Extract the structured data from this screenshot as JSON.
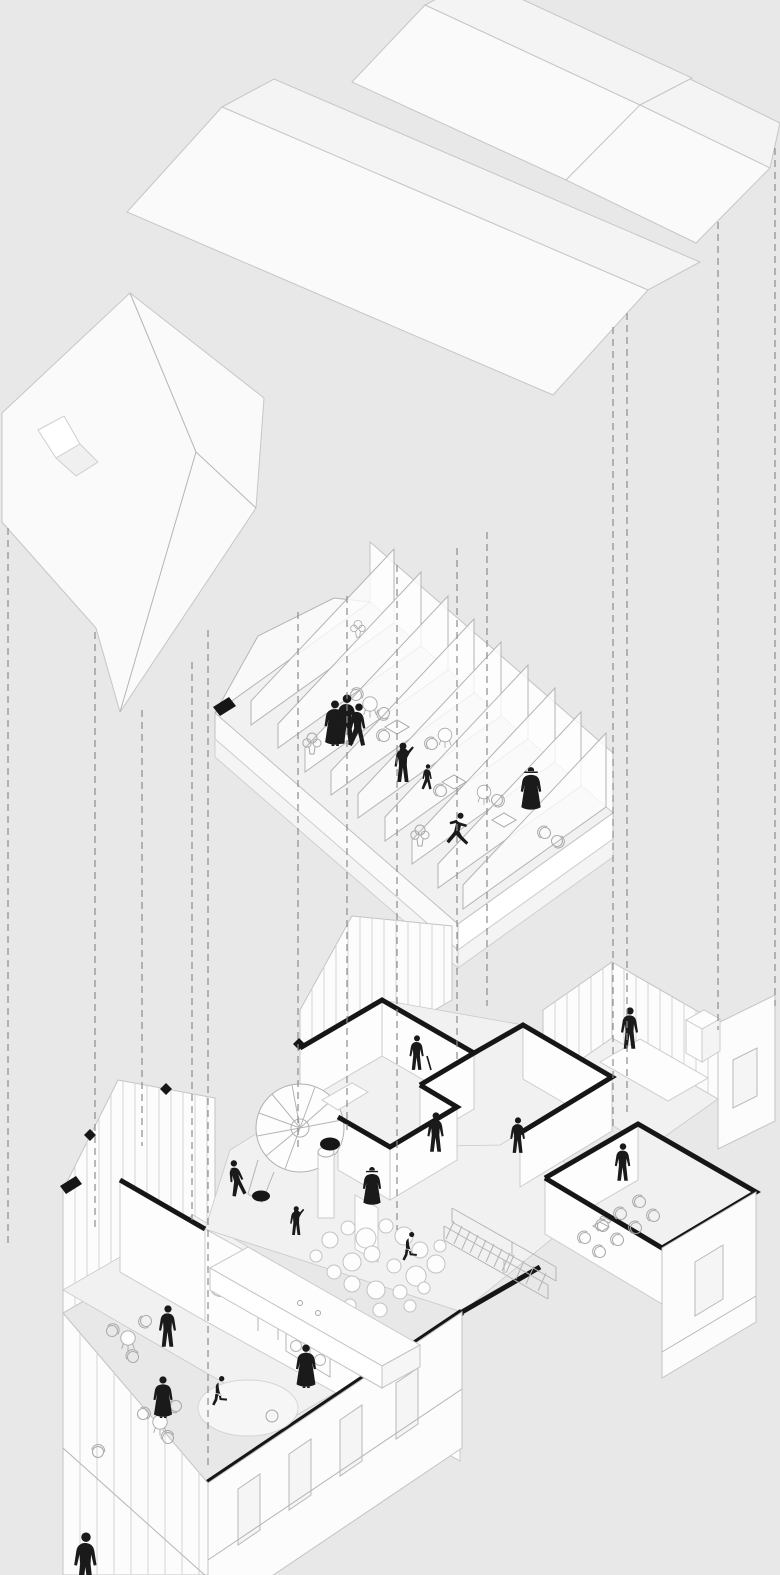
{
  "meta": {
    "title": "Exploded axonometric diagram of a two-storey gabled building",
    "type": "architectural-exploded-axonometric",
    "projection_style": "isometric",
    "visible_text": "none"
  },
  "palette": {
    "background": "#e8e8e8",
    "roof_white": "#fafafa",
    "roof_shaded": "#f4f4f4",
    "wall_white": "#fcfcfc",
    "floor_grey": "#f1f1f1",
    "line_light": "#c6c6c6",
    "line_mid": "#b0b0b0",
    "ink_black": "#161616",
    "dash_grey": "#8d8d8d"
  },
  "levels": [
    {
      "id": "roofs",
      "label": "detached roof planes",
      "elements": [
        "central gabled roof plane",
        "twin gable roof planes north-east",
        "east roof plane",
        "south-west gabled roof plane with notch facets"
      ],
      "figure_count": 0
    },
    {
      "id": "upper-floor",
      "label": "upper floor (attic)",
      "elements": [
        "floor slab with fascia bands",
        "back parapet",
        "nine sloped partition fins",
        "tables and chairs in bays",
        "potted plants"
      ],
      "figure_count": 7
    },
    {
      "id": "ground-floor",
      "label": "ground floor",
      "elements": [
        "cafe with counter, wall mirror, arch niche, machines and round rug",
        "spiral staircase with column and black poufs",
        "hall with cluster of white poufs",
        "straight staircase with railings",
        "meeting room with rows of chairs",
        "kitchen with long table and cabinet",
        "gable end walls with board siding",
        "window openings",
        "section cut walls drawn black",
        "diamond section markers"
      ],
      "figure_count": 14
    }
  ],
  "figures": [
    {
      "level": "upper-floor",
      "pose": "standing in long coat (group left)"
    },
    {
      "level": "upper-floor",
      "pose": "standing (group centre)"
    },
    {
      "level": "upper-floor",
      "pose": "walking (group right)"
    },
    {
      "level": "upper-floor",
      "pose": "parent reaching toward child"
    },
    {
      "level": "upper-floor",
      "pose": "child walking"
    },
    {
      "level": "upper-floor",
      "pose": "dancing / striding"
    },
    {
      "level": "upper-floor",
      "pose": "woman with hat in long dress"
    },
    {
      "level": "ground-floor",
      "pose": "standing behind cafe counter"
    },
    {
      "level": "ground-floor",
      "pose": "visitor in long coat beside counter"
    },
    {
      "level": "ground-floor",
      "pose": "standing in coat by cafe tables"
    },
    {
      "level": "ground-floor",
      "pose": "sitting on round rug"
    },
    {
      "level": "ground-floor",
      "pose": "figure clipped at bottom edge"
    },
    {
      "level": "ground-floor",
      "pose": "climbing spiral stair"
    },
    {
      "level": "ground-floor",
      "pose": "gesturing in hall"
    },
    {
      "level": "ground-floor",
      "pose": "woman with hat in hall"
    },
    {
      "level": "ground-floor",
      "pose": "sitting at hall edge"
    },
    {
      "level": "ground-floor",
      "pose": "standing in middle room"
    },
    {
      "level": "ground-floor",
      "pose": "standing in meeting room"
    },
    {
      "level": "ground-floor",
      "pose": "standing in kitchen"
    },
    {
      "level": "ground-floor",
      "pose": "standing in corridor room"
    },
    {
      "level": "ground-floor",
      "pose": "standing with cane"
    }
  ],
  "projection_lines": {
    "style": "dashed vertical",
    "count": 14
  },
  "markers": {
    "diamond_count": 3,
    "pouf_black_count": 2
  }
}
